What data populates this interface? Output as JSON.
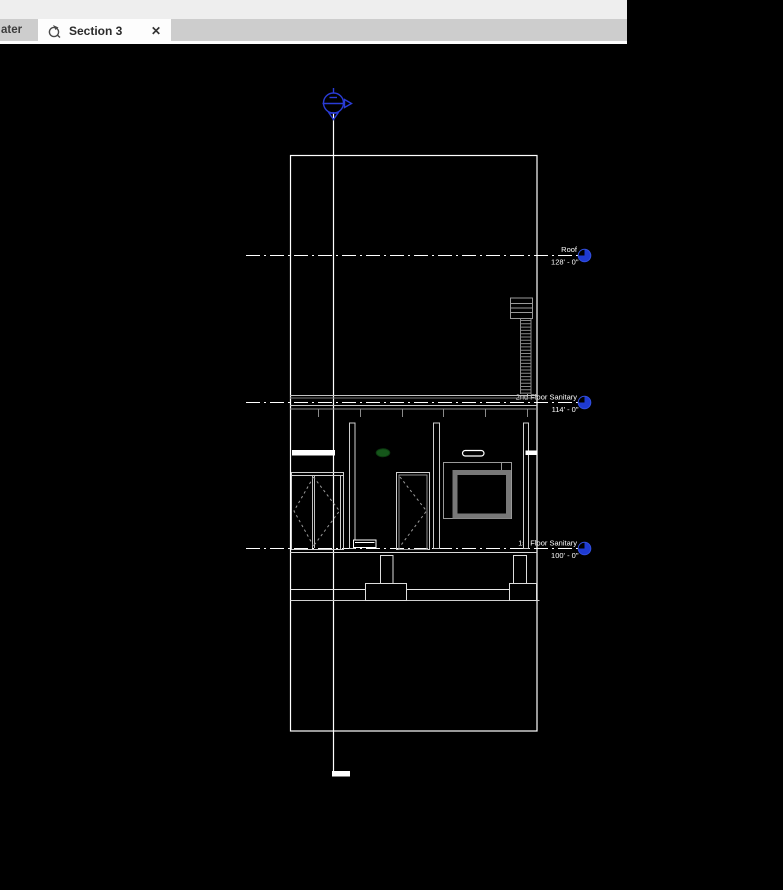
{
  "window": {
    "tab_partial_label": "ater",
    "tab_active": {
      "label": "Section 3",
      "close_glyph": "✕"
    }
  },
  "drawing": {
    "view_type": "building-section",
    "levels": [
      {
        "name": "Roof",
        "elevation": "128' - 0\""
      },
      {
        "name": "2nd Floor Sanitary",
        "elevation": "114' - 0\""
      },
      {
        "name": "1st Floor Sanitary",
        "elevation": "100' - 0\""
      }
    ],
    "colors": {
      "background": "#000000",
      "line_white": "#ffffff",
      "detail_gray": "#8a8a8a",
      "level_head_blue": "#1e3ad2",
      "grid_bubble_blue": "#2a3cd6",
      "fixture_green": "#15561a"
    }
  }
}
